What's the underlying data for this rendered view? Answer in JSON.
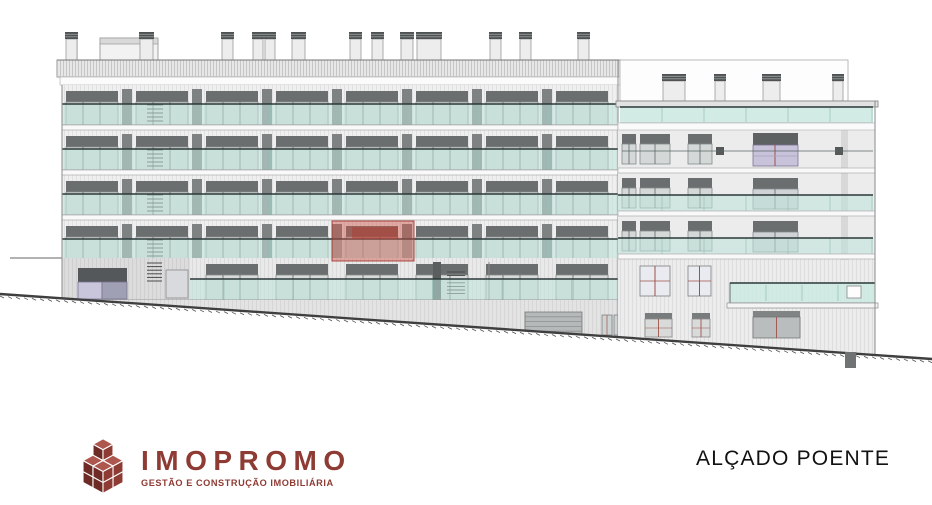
{
  "title": {
    "label": "ALÇADO POENTE"
  },
  "logo": {
    "name": "IMOPROMO",
    "tagline": "GESTÃO E CONSTRUÇÃO IMOBILIÁRIA",
    "brand_color": "#8e3b34",
    "cube_colors": {
      "top": "#ad574f",
      "right": "#8e3b34",
      "left": "#6e2b26",
      "seam": "#ffffff"
    }
  },
  "drawing": {
    "label": "west-elevation-building-drawing",
    "colors": {
      "wall": "#efefef",
      "slab": "#f9f9f9",
      "outline": "#8a8a8a",
      "header": "#6a6e6e",
      "glass": "#d6dbda",
      "glassStroke": "#858b8b",
      "mullion": "#5f6565",
      "teal": "#bfe3da",
      "tealEdge": "#6e7a7a",
      "handrail": "#2b3838",
      "joint": "#97c2ba",
      "pillar": "#7e8282",
      "purple": "#c8c2da",
      "purpleDark": "#9fa0b4",
      "redMullion": "#a0524a",
      "ground": "#3f3f3f",
      "basement": "#e3e3e3",
      "garage": "#b5b9b9",
      "chimney": "#ededed",
      "cap": "#4e5252",
      "highlightFill": "rgba(206,82,72,0.45)",
      "highlightStroke": "rgba(158,48,42,0.85)",
      "highlightInner": "rgba(148,44,38,0.5)"
    },
    "ground": {
      "x1": 0,
      "y1": 294,
      "x2": 932,
      "y2": 359,
      "post": {
        "x": 845,
        "y": 352,
        "w": 11,
        "h": 16
      },
      "left_wall_line": {
        "x1": 10,
        "y1": 258,
        "x2": 62,
        "y2": 258
      }
    },
    "left_block": {
      "x": 62,
      "w": 556,
      "roof": {
        "x": 57,
        "y": 60,
        "w": 565,
        "h": 17
      },
      "parapet": {
        "y": 77,
        "h": 8
      },
      "floor_tops": [
        85,
        130,
        175,
        220
      ],
      "floor_h": 45,
      "module_xs": [
        66,
        136,
        206,
        276,
        346,
        416,
        486,
        556
      ],
      "module_w": 52,
      "stair_x": 147,
      "penthouse": {
        "x": 100,
        "y": 38,
        "w": 58,
        "h": 22
      },
      "antenna_x": 77,
      "chimneys": [
        {
          "x": 66,
          "w": 11
        },
        {
          "x": 140,
          "w": 13
        },
        {
          "x": 222,
          "w": 11
        },
        {
          "x": 253,
          "w": 10
        },
        {
          "x": 265,
          "w": 10
        },
        {
          "x": 292,
          "w": 13
        },
        {
          "x": 350,
          "w": 11
        },
        {
          "x": 372,
          "w": 11
        },
        {
          "x": 401,
          "w": 12
        },
        {
          "x": 417,
          "w": 24
        },
        {
          "x": 490,
          "w": 11
        },
        {
          "x": 520,
          "w": 11
        },
        {
          "x": 578,
          "w": 11
        }
      ],
      "ground_floor": {
        "top": 258,
        "storefront": {
          "x": 78,
          "w": 49
        },
        "garage": {
          "x": 525,
          "y": 312,
          "w": 57,
          "h": 24
        },
        "small_windows": [
          602,
          614
        ]
      }
    },
    "right_block": {
      "x": 618,
      "w": 257,
      "penthouse": {
        "x": 620,
        "y": 60,
        "w": 228,
        "h": 41
      },
      "chimneys": [
        {
          "x": 663,
          "w": 22
        },
        {
          "x": 715,
          "w": 10
        },
        {
          "x": 763,
          "w": 17
        },
        {
          "x": 833,
          "w": 10
        }
      ],
      "roof_slab": {
        "x": 616,
        "y": 101,
        "w": 262,
        "h": 6
      },
      "terrace_glass": {
        "y": 107,
        "h": 16
      },
      "floor_tops": [
        130,
        173,
        216
      ],
      "small_windows": [
        {
          "x": 622,
          "w": 14
        },
        {
          "x": 640,
          "w": 30
        },
        {
          "x": 688,
          "w": 24
        }
      ],
      "wide_window": {
        "x": 753,
        "w": 45
      },
      "vents": [
        716,
        835
      ],
      "pilaster_x": 841,
      "balcony": {
        "x": 730,
        "y": 283,
        "w": 145,
        "h": 20
      },
      "lower_windows": [
        {
          "x": 640,
          "w": 30
        },
        {
          "x": 688,
          "w": 23
        }
      ],
      "bottom_windows": [
        {
          "x": 645,
          "w": 27
        },
        {
          "x": 692,
          "w": 18
        }
      ],
      "bottom_garage": {
        "x": 753,
        "y": 311,
        "w": 47,
        "h": 27
      }
    },
    "highlight": {
      "x": 332,
      "y": 221,
      "w": 82,
      "h": 40,
      "inner": {
        "x": 352,
        "y": 227,
        "w": 46,
        "h": 12
      }
    }
  }
}
